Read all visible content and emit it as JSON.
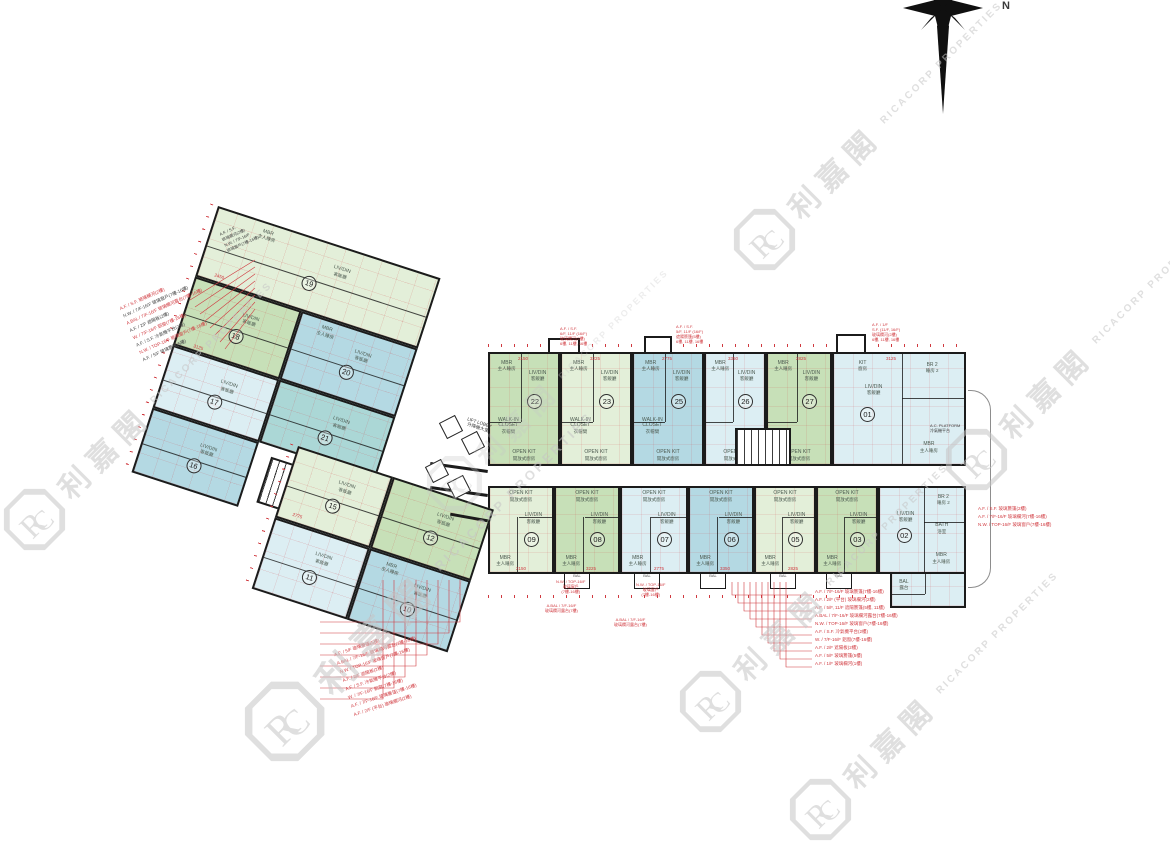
{
  "page": {
    "bg": "#ffffff"
  },
  "compass": {
    "label": "N"
  },
  "watermark": {
    "cn": "利嘉閣",
    "en": "RICACORP PROPERTIES",
    "color": "#c6c6c6"
  },
  "palette": {
    "green_mid": "#c7e0b8",
    "green_pale": "#e3efd9",
    "blue_mid": "#b4d9e3",
    "blue_pale": "#dceef3",
    "teal_mid": "#abd7d6",
    "wall": "#1b1b1b",
    "annotation_red": "#d0393f",
    "watermark_gray": "#c6c6c6"
  },
  "legend": {
    "livdin": "LIV/DIN",
    "livdin_cn": "客飯廳",
    "mbr": "MBR",
    "mbr_cn": "主人睡房",
    "walkin": "WALK-IN CLOSET",
    "walkin_cn": "衣帽間",
    "bath": "BATH",
    "bath_cn": "浴室",
    "openkit": "OPEN KIT",
    "openkit_cn": "開放式廚房",
    "kit": "KIT",
    "kit_cn": "廚房",
    "br2": "BR 2",
    "br2_cn": "睡房 2",
    "bal": "BAL",
    "bal_cn": "露台",
    "ac": "A.C. PLATFORM",
    "ac_cn": "冷氣機平台"
  },
  "core": {
    "lobby": "LIFT LOBBY",
    "lobby_cn": "升降機大堂",
    "lift": "LIFT",
    "lift_cn": "升降機"
  },
  "slab": {
    "top_row": [
      {
        "no": "22"
      },
      {
        "no": "23"
      },
      {
        "no": "25"
      },
      {
        "no": "26"
      },
      {
        "no": "27"
      },
      {
        "no": "01"
      }
    ],
    "bottom_row": [
      {
        "no": "09"
      },
      {
        "no": "08"
      },
      {
        "no": "07"
      },
      {
        "no": "06"
      },
      {
        "no": "05"
      },
      {
        "no": "03"
      },
      {
        "no": "02"
      }
    ]
  },
  "wing": {
    "units": [
      {
        "no": "19"
      },
      {
        "no": "18"
      },
      {
        "no": "20"
      },
      {
        "no": "17"
      },
      {
        "no": "21"
      },
      {
        "no": "16"
      },
      {
        "no": "15"
      },
      {
        "no": "12"
      },
      {
        "no": "11"
      },
      {
        "no": "10"
      }
    ]
  },
  "dims": [
    "2150",
    "3225",
    "2775",
    "3350",
    "2825",
    "3125",
    "2150",
    "3225",
    "2775",
    "3350",
    "2825",
    "2450",
    "3125",
    "2775"
  ],
  "annotations": {
    "top": [
      [
        "A.F. / S.F.",
        "6/F, 11/F (16/F)",
        "玻璃欄河(2樓)",
        "6樓, 11樓, 16樓"
      ],
      [
        "A.F. / S.F.",
        "5/F, 11/F (16/F)",
        "遮陽簷篷(5樓)",
        "6樓, 11樓, 16樓"
      ],
      [
        "A.F. / 1/F",
        "S.F. (11/F, 16/F)",
        "玻璃欄河(2樓)",
        "6樓, 11樓, 16樓"
      ]
    ],
    "top_left": [
      "A.F. / S.F.",
      "玻璃欄河(2樓)",
      "N.W. / 7/F-16/F",
      "玻璃窗戶(7樓-16樓)"
    ],
    "left": [
      "A.F. / S.F. 玻璃欄河(2樓)",
      "N.W. / 7/F-16/F 玻璃窗戶(7樓-16樓)",
      "A.BAL / 7/F-16/F 玻璃欄河露台(7樓-16樓)",
      "A.F. / 2/F 遮陽板(2樓)",
      "W. / 7/F-16/F 鋁窗(7樓-16樓)",
      "A.F. / S.F. 冷氣機平台(2樓)",
      "N.W. / TOP-16/F 玻璃窗戶(7樓-16樓)",
      "A.F. / 5/F 玻璃簷篷(5樓)"
    ],
    "bottom_left": [
      "A.F. / 5/F 玻璃簷篷(5樓)",
      "A.BAL / 7/F-16/F 玻璃欄河露台(7樓-16樓)",
      "N.W. / TOP-16/F 玻璃窗戶(7樓-16樓)",
      "A.F. / 2/F 遮陽板(2樓)",
      "A.F. / S.F. 冷氣機平台(2樓)",
      "W. / 7/F-16/F 鋁窗(7樓-16樓)",
      "A.F. / 7/F-16/F 玻璃簷篷(7樓-16樓)",
      "A.F. / 2/F (平台) 玻璃欄河(2樓)"
    ],
    "bottom_center": [
      "A.F. / 7/F-16/F 玻璃簷篷(7樓-16樓)",
      "A.F. / 2/F (平台) 玻璃欄河(2樓)",
      "A.F. / 5/F, 11/F 遮陽簷篷(5樓, 11樓)",
      "A.BAL / 7/F-16/F 玻璃欄河露台(7樓-16樓)",
      "N.W. / TOP-16/F 玻璃窗戶(7樓-16樓)",
      "A.F. / S.F. 冷氣機平台(2樓)",
      "W. / 7/F-16/F 鋁窗(7樓-16樓)",
      "A.F. / 2/F 遮陽板(2樓)",
      "A.F. / 5/F 玻璃簷篷(5樓)",
      "A.F. / 1/F 玻璃欄河(1樓)"
    ],
    "right": [
      "A.F. / S.F. 玻璃簷篷(2樓)",
      "A.F. / 7/F-16/F 玻璃欄河(7樓-16樓)",
      "N.W. / TOP-16/F 玻璃窗戶(7樓-16樓)"
    ],
    "balcony": [
      "N.W. / TOP-16/F",
      "玻璃窗戶",
      "(7樓-16樓)"
    ],
    "abal": [
      "A.BAL / 7/F-16/F",
      "玻璃欄河露台(7樓)"
    ]
  }
}
